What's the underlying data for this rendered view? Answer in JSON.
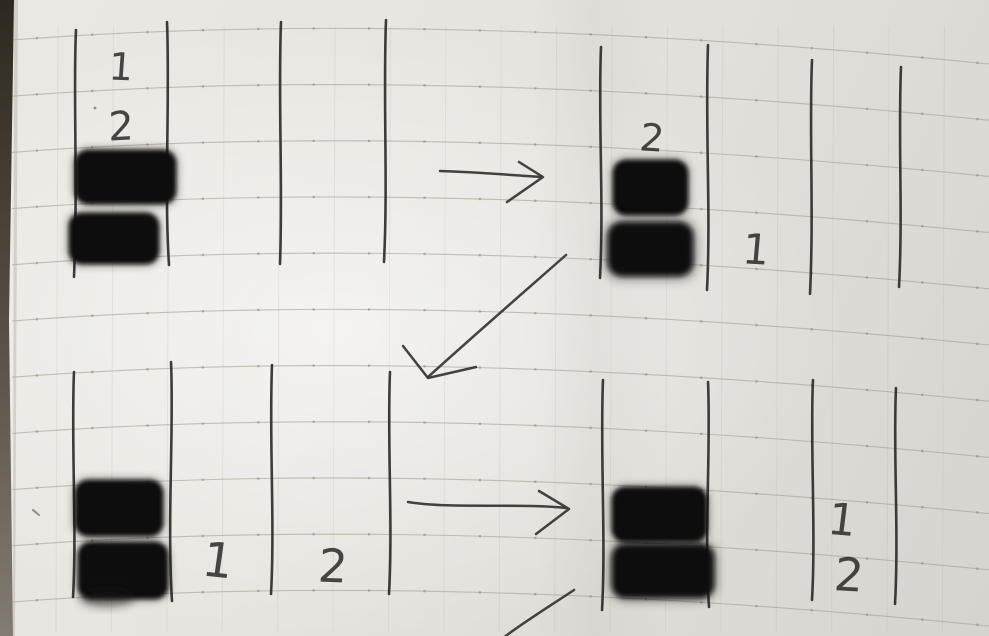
{
  "colors": {
    "paper": "#e7e5df",
    "paper_shadow": "#d6d4ce",
    "ink": "#2f2d2a",
    "marker_block": "#0a0a0a",
    "ruled_line": "#a39f95",
    "grid_dot": "#837f75",
    "page_edge": "#3a332b"
  },
  "panels": [
    {
      "id": "state-1",
      "position": "top-left",
      "column_lines": 4,
      "blocks": {
        "count": 2,
        "column": 1,
        "arrangement": "stacked"
      },
      "labels": [
        {
          "text": "1",
          "column": 1,
          "placement": "above blocks"
        },
        {
          "text": "2",
          "column": 1,
          "placement": "above blocks, below label 1"
        }
      ]
    },
    {
      "id": "state-2",
      "position": "top-right",
      "column_lines": 4,
      "blocks": {
        "count": 2,
        "column": 1,
        "arrangement": "stacked"
      },
      "labels": [
        {
          "text": "2",
          "column": 1,
          "placement": "above blocks"
        },
        {
          "text": "1",
          "column": 2,
          "placement": "beside lower block"
        }
      ]
    },
    {
      "id": "state-3",
      "position": "bottom-left",
      "column_lines": 4,
      "blocks": {
        "count": 2,
        "column": 1,
        "arrangement": "stacked"
      },
      "labels": [
        {
          "text": "1",
          "column": 2,
          "placement": "lower area"
        },
        {
          "text": "2",
          "column": 3,
          "placement": "lower area"
        }
      ]
    },
    {
      "id": "state-4",
      "position": "bottom-right",
      "column_lines": 4,
      "blocks": {
        "count": 2,
        "column": 1,
        "arrangement": "stacked"
      },
      "labels": [
        {
          "text": "1",
          "column": 3,
          "placement": "upper"
        },
        {
          "text": "2",
          "column": 3,
          "placement": "below label 1"
        }
      ]
    }
  ],
  "arrows": [
    {
      "id": "arrow-1",
      "direction": "right",
      "connects": "state-1 to state-2"
    },
    {
      "id": "arrow-2",
      "direction": "down-left",
      "connects": "state-2 to state-3"
    },
    {
      "id": "arrow-3",
      "direction": "right",
      "connects": "state-3 to state-4"
    },
    {
      "id": "arrow-4",
      "direction": "down-left",
      "connects": "state-4 onward, cut off at bottom edge"
    }
  ]
}
